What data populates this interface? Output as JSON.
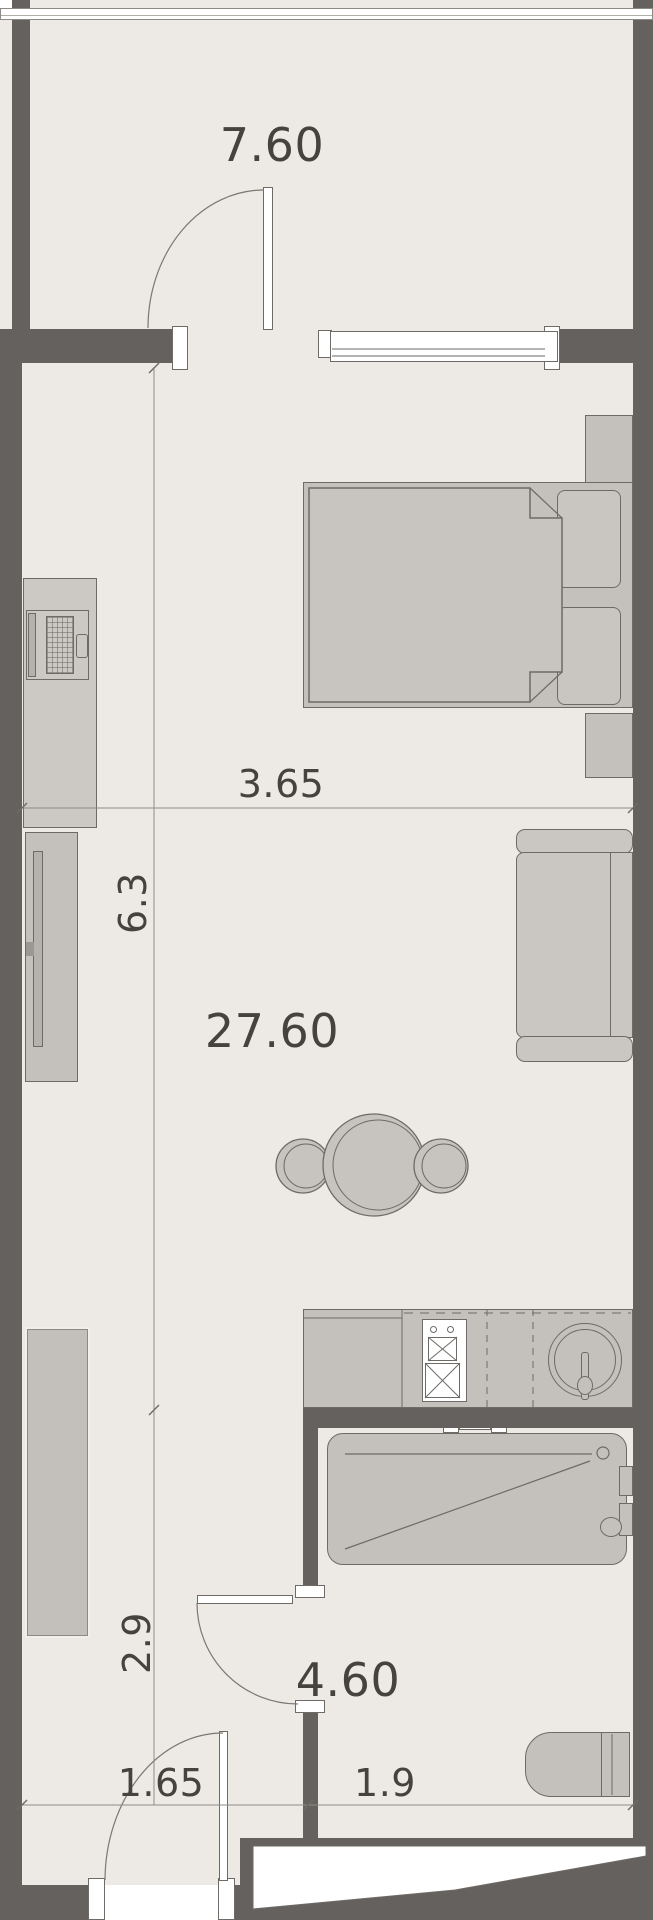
{
  "floorplan": {
    "title": "studio-apartment-floor-plan",
    "labels": {
      "balcony_area": "7.60",
      "living_area": "27.60",
      "bathroom_area": "4.60",
      "dim_living_width": "3.65",
      "dim_living_length": "6.3",
      "dim_hall_length": "2.9",
      "dim_hall_width": "1.65",
      "dim_bathroom_width": "1.9"
    },
    "colors": {
      "floor": "#edeae6",
      "wall": "#64615e",
      "furniture": "#c4c0bc",
      "furniture_light": "#cac6c2",
      "outline": "#6e6a66",
      "dim_line": "#8f8b87",
      "text": "#454240",
      "white": "#ffffff"
    }
  }
}
